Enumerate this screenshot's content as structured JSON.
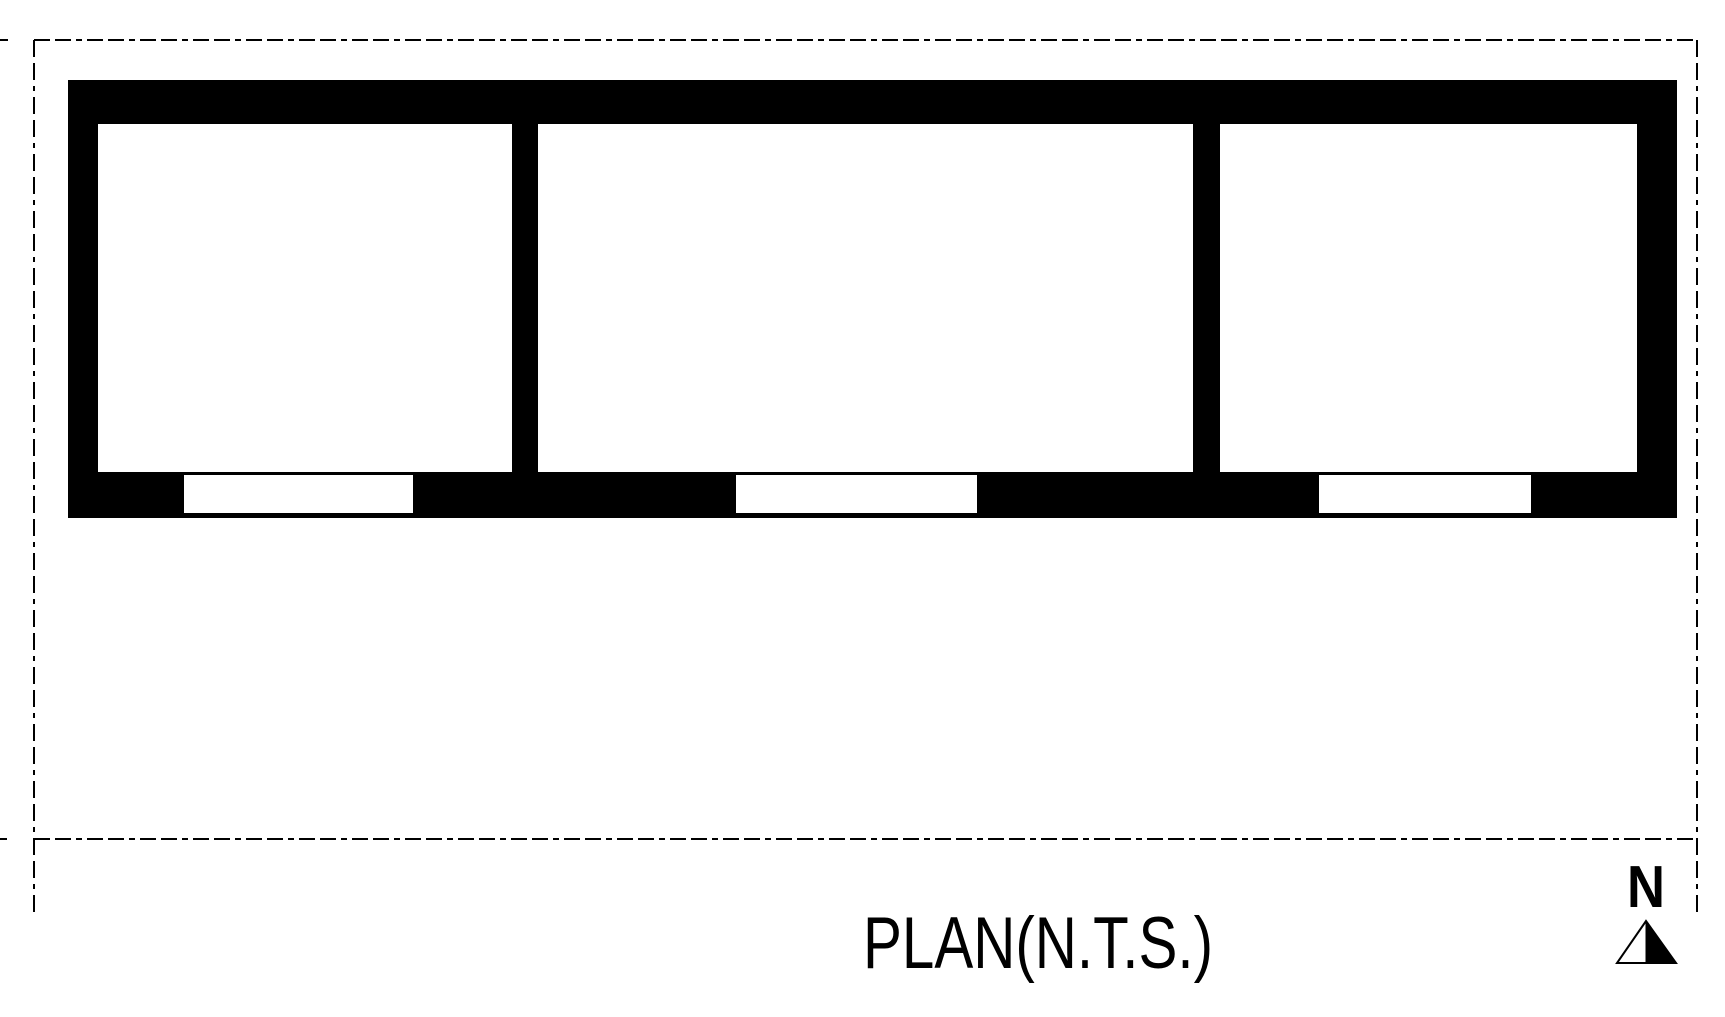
{
  "page": {
    "background_color": "#ffffff",
    "ink_color": "#000000"
  },
  "plan": {
    "title": "PLAN(N.T.S.)",
    "scale_note": "N.T.S.",
    "north": {
      "label": "N"
    },
    "site_boundary": {
      "style": "dashed"
    },
    "building": {
      "room_count": 3,
      "door_opening_count": 3
    }
  }
}
